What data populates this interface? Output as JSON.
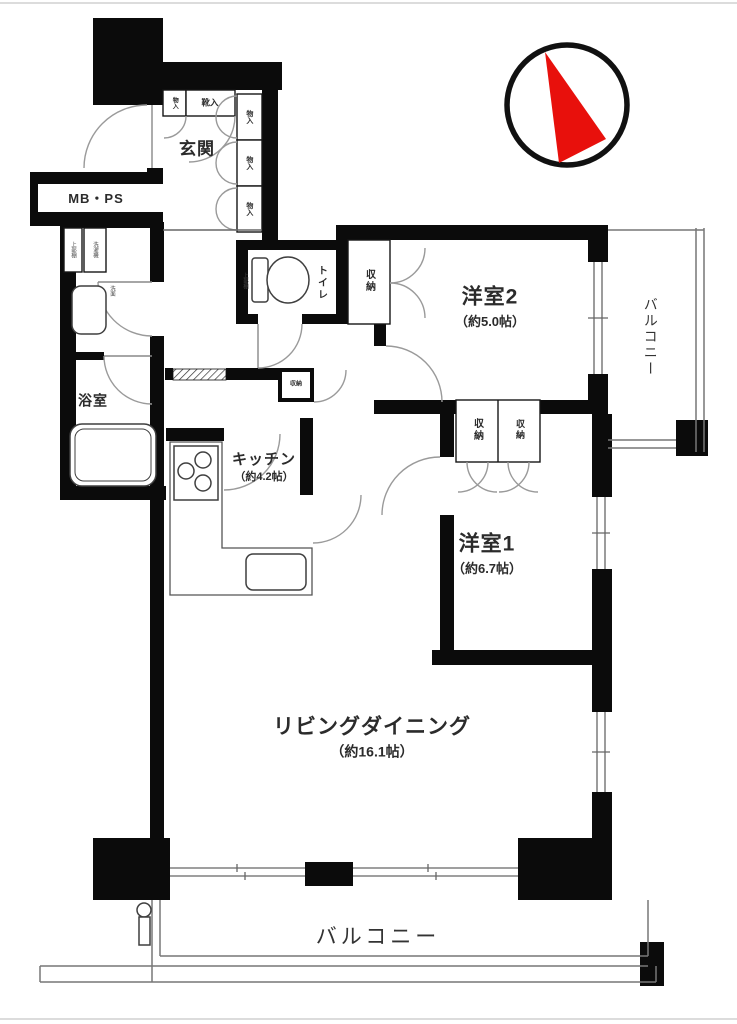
{
  "compass": {
    "arrow_color": "#e8100c",
    "ring_color": "#111111"
  },
  "labels": {
    "genkan": "玄関",
    "mbps": "MB・PS",
    "bath": "浴室",
    "toilet": "トイレ",
    "toilet_shelf": "上部棚",
    "wash_upper": "上部棚",
    "washer": "洗濯機",
    "basin": "洗面",
    "bedroom2_name": "洋室2",
    "bedroom2_size": "（約5.0帖）",
    "bedroom1_name": "洋室1",
    "bedroom1_size": "（約6.7帖）",
    "kitchen_name": "キッチン",
    "kitchen_size": "（約4.2帖）",
    "living_name": "リビングダイニング",
    "living_size": "（約16.1帖）",
    "balcony_side": "バルコニー",
    "balcony_bottom": "バルコニー",
    "closet_shoes": "靴入",
    "closet_small": "物入",
    "closet_side_1": "物入",
    "closet_side_2": "物入",
    "closet_side_3": "物入",
    "closet_toilet": "収納",
    "closet_hall": "収納",
    "closet_b1_a": "収納",
    "closet_b1_b": "収納"
  }
}
